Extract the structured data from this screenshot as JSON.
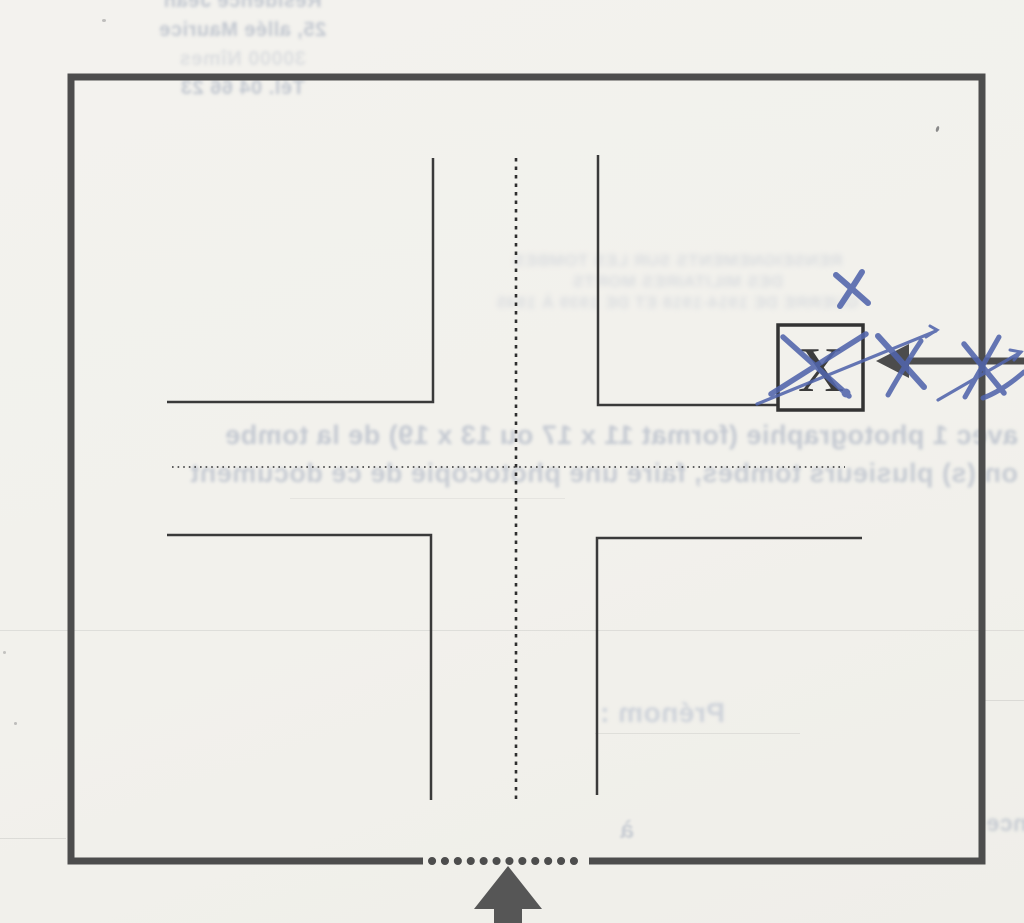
{
  "diagram": {
    "marker_letter": "X"
  },
  "annotations": {
    "pen_color": "#5165ac",
    "ink_color": "#4c4c4c",
    "paper_color": "#f2f1ec"
  },
  "bleed_through": {
    "address_lines": [
      "Résidence Jean",
      "25, allée Maurice",
      "30000 Nîmes",
      "Tél. 04 66 23"
    ],
    "heading_lines": [
      "RENSEIGNEMENTS SUR LES TOMBES",
      "DES MILITAIRES MORTS",
      "GUERRE DE 1914-1918 ET DE 1939 À 1945"
    ],
    "instruction_line_1": "avec 1 photographie (format 11 x 17 ou 13 x 19) de la tombe",
    "instruction_line_2": "on (s) plusieurs tombes, faire une photocopie de ce document",
    "prenom_label": "Prénom :",
    "a_label": "à",
    "seance_fragment": "séance"
  }
}
